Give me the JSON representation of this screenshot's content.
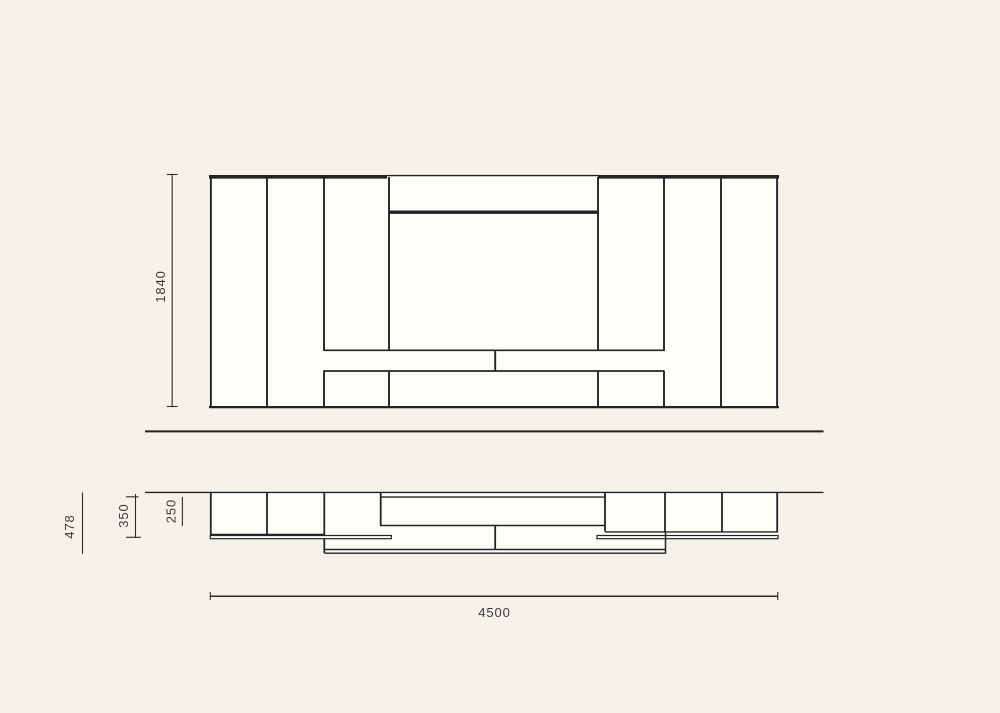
{
  "page": {
    "title": "Wall unit technical drawing — front elevation and top plan",
    "background_color": "#f4f2e9"
  },
  "elevation": {
    "height_dim": "1840"
  },
  "plan": {
    "width_dim": "4500",
    "depth_dims": {
      "overall": "478",
      "cabinet": "350",
      "panel": "250"
    }
  },
  "colors": {
    "background": "#f4f2e9",
    "surface": "#fdfdfa",
    "line": "#232323",
    "dim_line": "#2d2d2d",
    "text": "#3a3a3a"
  }
}
